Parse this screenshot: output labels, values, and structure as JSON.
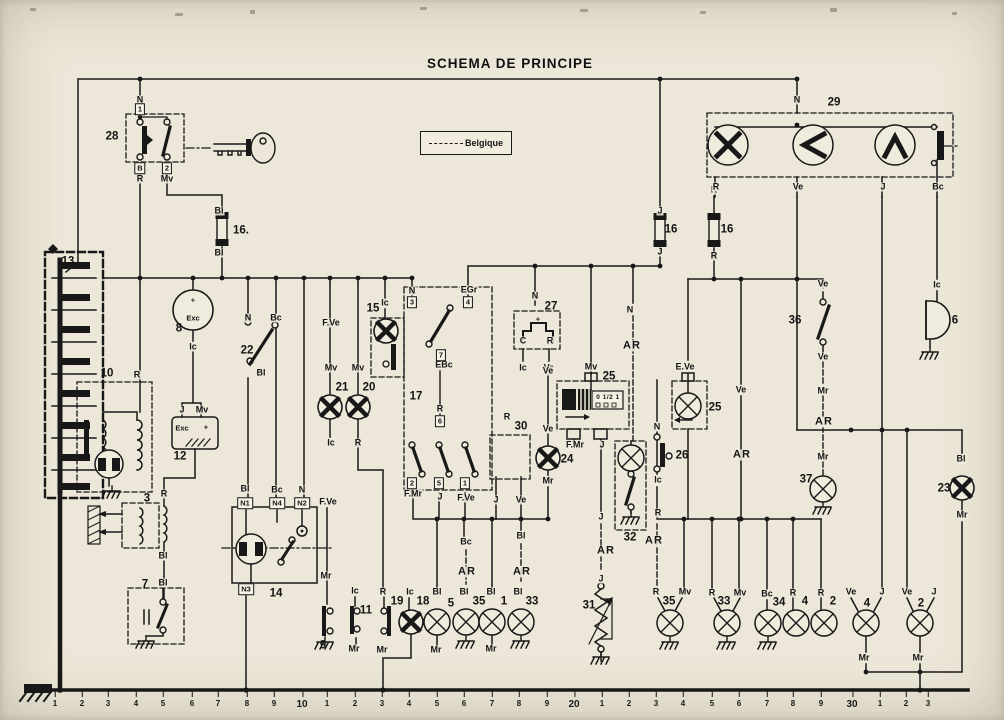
{
  "title": "SCHEMA DE PRINCIPE",
  "legend": {
    "label": "Belgique"
  },
  "colors": {
    "paper": "#ece7d8",
    "ink": "#181818"
  },
  "labels": [
    {
      "t": "28",
      "x": 112,
      "y": 137,
      "k": "c"
    },
    {
      "t": "16.",
      "x": 241,
      "y": 231,
      "k": "c"
    },
    {
      "t": "13",
      "x": 68,
      "y": 262,
      "k": "c"
    },
    {
      "t": "8",
      "x": 179,
      "y": 329,
      "k": "c"
    },
    {
      "t": "22",
      "x": 247,
      "y": 351,
      "k": "c"
    },
    {
      "t": "10",
      "x": 107,
      "y": 374,
      "k": "c"
    },
    {
      "t": "15",
      "x": 373,
      "y": 309,
      "k": "c"
    },
    {
      "t": "21",
      "x": 342,
      "y": 388,
      "k": "c"
    },
    {
      "t": "20",
      "x": 369,
      "y": 388,
      "k": "c"
    },
    {
      "t": "17",
      "x": 416,
      "y": 397,
      "k": "c"
    },
    {
      "t": "27",
      "x": 551,
      "y": 307,
      "k": "c"
    },
    {
      "t": "12",
      "x": 180,
      "y": 457,
      "k": "c"
    },
    {
      "t": "3",
      "x": 147,
      "y": 499,
      "k": "c"
    },
    {
      "t": "30",
      "x": 521,
      "y": 427,
      "k": "c"
    },
    {
      "t": "24",
      "x": 567,
      "y": 460,
      "k": "c"
    },
    {
      "t": "25",
      "x": 609,
      "y": 377,
      "k": "c"
    },
    {
      "t": "25",
      "x": 715,
      "y": 408,
      "k": "c"
    },
    {
      "t": "26",
      "x": 682,
      "y": 456,
      "k": "c"
    },
    {
      "t": "32",
      "x": 630,
      "y": 538,
      "k": "c"
    },
    {
      "t": "14",
      "x": 276,
      "y": 594,
      "k": "c"
    },
    {
      "t": "7",
      "x": 145,
      "y": 585,
      "k": "c"
    },
    {
      "t": "9",
      "x": 323,
      "y": 646,
      "k": "c"
    },
    {
      "t": "11",
      "x": 366,
      "y": 611,
      "k": "c"
    },
    {
      "t": "19",
      "x": 397,
      "y": 602,
      "k": "c"
    },
    {
      "t": "18",
      "x": 423,
      "y": 602,
      "k": "c"
    },
    {
      "t": "5",
      "x": 451,
      "y": 604,
      "k": "c"
    },
    {
      "t": "35",
      "x": 479,
      "y": 602,
      "k": "c"
    },
    {
      "t": "1",
      "x": 504,
      "y": 602,
      "k": "c"
    },
    {
      "t": "33",
      "x": 532,
      "y": 602,
      "k": "c"
    },
    {
      "t": "31",
      "x": 589,
      "y": 606,
      "k": "c"
    },
    {
      "t": "35",
      "x": 669,
      "y": 602,
      "k": "c"
    },
    {
      "t": "33",
      "x": 724,
      "y": 602,
      "k": "c"
    },
    {
      "t": "34",
      "x": 779,
      "y": 603,
      "k": "c"
    },
    {
      "t": "4",
      "x": 805,
      "y": 602,
      "k": "c"
    },
    {
      "t": "2",
      "x": 833,
      "y": 602,
      "k": "c"
    },
    {
      "t": "4",
      "x": 867,
      "y": 604,
      "k": "c"
    },
    {
      "t": "2",
      "x": 921,
      "y": 604,
      "k": "c"
    },
    {
      "t": "36",
      "x": 795,
      "y": 321,
      "k": "c"
    },
    {
      "t": "37",
      "x": 806,
      "y": 480,
      "k": "c"
    },
    {
      "t": "6",
      "x": 955,
      "y": 321,
      "k": "c"
    },
    {
      "t": "23",
      "x": 944,
      "y": 489,
      "k": "c"
    },
    {
      "t": "29",
      "x": 834,
      "y": 103,
      "k": "c"
    },
    {
      "t": "16",
      "x": 671,
      "y": 230,
      "k": "c"
    },
    {
      "t": "16",
      "x": 727,
      "y": 230,
      "k": "c"
    },
    {
      "t": "N",
      "x": 140,
      "y": 100,
      "k": "w"
    },
    {
      "t": "R",
      "x": 140,
      "y": 179,
      "k": "w"
    },
    {
      "t": "Mv",
      "x": 167,
      "y": 179,
      "k": "w"
    },
    {
      "t": "Bl",
      "x": 219,
      "y": 211,
      "k": "w"
    },
    {
      "t": "Bl",
      "x": 219,
      "y": 253,
      "k": "w"
    },
    {
      "t": "Ic",
      "x": 193,
      "y": 347,
      "k": "w"
    },
    {
      "t": "N",
      "x": 248,
      "y": 318,
      "k": "w"
    },
    {
      "t": "Bc",
      "x": 276,
      "y": 318,
      "k": "w"
    },
    {
      "t": "Bl",
      "x": 261,
      "y": 373,
      "k": "w"
    },
    {
      "t": "F.Ve",
      "x": 331,
      "y": 323,
      "k": "w"
    },
    {
      "t": "Mv",
      "x": 331,
      "y": 368,
      "k": "w"
    },
    {
      "t": "Ic",
      "x": 331,
      "y": 443,
      "k": "w"
    },
    {
      "t": "Mv",
      "x": 358,
      "y": 368,
      "k": "w"
    },
    {
      "t": "R",
      "x": 358,
      "y": 443,
      "k": "w"
    },
    {
      "t": "Ic",
      "x": 385,
      "y": 303,
      "k": "w"
    },
    {
      "t": "N",
      "x": 412,
      "y": 291,
      "k": "w"
    },
    {
      "t": "EGr",
      "x": 469,
      "y": 290,
      "k": "w"
    },
    {
      "t": "EBc",
      "x": 444,
      "y": 365,
      "k": "w"
    },
    {
      "t": "R",
      "x": 440,
      "y": 409,
      "k": "w"
    },
    {
      "t": "F.Mr",
      "x": 413,
      "y": 494,
      "k": "w"
    },
    {
      "t": "J",
      "x": 440,
      "y": 497,
      "k": "w"
    },
    {
      "t": "F.Ve",
      "x": 466,
      "y": 498,
      "k": "w"
    },
    {
      "t": "N",
      "x": 535,
      "y": 296,
      "k": "w"
    },
    {
      "t": "C",
      "x": 523,
      "y": 341,
      "k": "w"
    },
    {
      "t": "R",
      "x": 550,
      "y": 341,
      "k": "w"
    },
    {
      "t": "Ic",
      "x": 523,
      "y": 368,
      "k": "w"
    },
    {
      "t": "Ve",
      "x": 549,
      "y": 368,
      "k": "w"
    },
    {
      "t": "R",
      "x": 507,
      "y": 417,
      "k": "w"
    },
    {
      "t": "J",
      "x": 496,
      "y": 500,
      "k": "w"
    },
    {
      "t": "Ve",
      "x": 521,
      "y": 500,
      "k": "w"
    },
    {
      "t": "Ve",
      "x": 548,
      "y": 371,
      "k": "w"
    },
    {
      "t": "Ve",
      "x": 548,
      "y": 429,
      "k": "w"
    },
    {
      "t": "Mr",
      "x": 548,
      "y": 481,
      "k": "w"
    },
    {
      "t": "Mv",
      "x": 591,
      "y": 367,
      "k": "w"
    },
    {
      "t": "F.Mr",
      "x": 575,
      "y": 445,
      "k": "w"
    },
    {
      "t": "J",
      "x": 602,
      "y": 445,
      "k": "w"
    },
    {
      "t": "N",
      "x": 630,
      "y": 310,
      "k": "w"
    },
    {
      "t": "J",
      "x": 660,
      "y": 211,
      "k": "w"
    },
    {
      "t": "J",
      "x": 660,
      "y": 252,
      "k": "w"
    },
    {
      "t": "R",
      "x": 714,
      "y": 190,
      "k": "w"
    },
    {
      "t": "R",
      "x": 714,
      "y": 256,
      "k": "w"
    },
    {
      "t": "N",
      "x": 797,
      "y": 100,
      "k": "w"
    },
    {
      "t": "R",
      "x": 716,
      "y": 187,
      "k": "w"
    },
    {
      "t": "Ve",
      "x": 798,
      "y": 187,
      "k": "w"
    },
    {
      "t": "J",
      "x": 883,
      "y": 187,
      "k": "w"
    },
    {
      "t": "Bc",
      "x": 938,
      "y": 187,
      "k": "w"
    },
    {
      "t": "Ic",
      "x": 937,
      "y": 285,
      "k": "w"
    },
    {
      "t": "Ve",
      "x": 823,
      "y": 284,
      "k": "w"
    },
    {
      "t": "Ve",
      "x": 823,
      "y": 357,
      "k": "w"
    },
    {
      "t": "Mr",
      "x": 823,
      "y": 391,
      "k": "w"
    },
    {
      "t": "Mr",
      "x": 823,
      "y": 457,
      "k": "w"
    },
    {
      "t": "Ve",
      "x": 741,
      "y": 390,
      "k": "w"
    },
    {
      "t": "E.Ve",
      "x": 685,
      "y": 367,
      "k": "w"
    },
    {
      "t": "N",
      "x": 657,
      "y": 427,
      "k": "w"
    },
    {
      "t": "Ic",
      "x": 658,
      "y": 480,
      "k": "w"
    },
    {
      "t": "R",
      "x": 658,
      "y": 513,
      "k": "w"
    },
    {
      "t": "Bl",
      "x": 961,
      "y": 459,
      "k": "w"
    },
    {
      "t": "Mr",
      "x": 962,
      "y": 515,
      "k": "w"
    },
    {
      "t": "Bc",
      "x": 466,
      "y": 542,
      "k": "w"
    },
    {
      "t": "Bl",
      "x": 521,
      "y": 536,
      "k": "w"
    },
    {
      "t": "J",
      "x": 601,
      "y": 517,
      "k": "w"
    },
    {
      "t": "J",
      "x": 601,
      "y": 579,
      "k": "w"
    },
    {
      "t": "F.Ve",
      "x": 328,
      "y": 502,
      "k": "w"
    },
    {
      "t": "Mr",
      "x": 326,
      "y": 576,
      "k": "w"
    },
    {
      "t": "Ic",
      "x": 355,
      "y": 591,
      "k": "w"
    },
    {
      "t": "Mr",
      "x": 354,
      "y": 649,
      "k": "w"
    },
    {
      "t": "R",
      "x": 383,
      "y": 592,
      "k": "w"
    },
    {
      "t": "Mr",
      "x": 382,
      "y": 650,
      "k": "w"
    },
    {
      "t": "Ic",
      "x": 410,
      "y": 592,
      "k": "w"
    },
    {
      "t": "Bl",
      "x": 437,
      "y": 592,
      "k": "w"
    },
    {
      "t": "Mr",
      "x": 436,
      "y": 650,
      "k": "w"
    },
    {
      "t": "Bl",
      "x": 464,
      "y": 592,
      "k": "w"
    },
    {
      "t": "Bl",
      "x": 491,
      "y": 592,
      "k": "w"
    },
    {
      "t": "Mr",
      "x": 491,
      "y": 649,
      "k": "w"
    },
    {
      "t": "Bl",
      "x": 518,
      "y": 592,
      "k": "w"
    },
    {
      "t": "Bl",
      "x": 245,
      "y": 489,
      "k": "w"
    },
    {
      "t": "Bc",
      "x": 277,
      "y": 490,
      "k": "w"
    },
    {
      "t": "N",
      "x": 302,
      "y": 490,
      "k": "w"
    },
    {
      "t": "R",
      "x": 164,
      "y": 494,
      "k": "w"
    },
    {
      "t": "Bl",
      "x": 163,
      "y": 556,
      "k": "w"
    },
    {
      "t": "Bl",
      "x": 163,
      "y": 583,
      "k": "w"
    },
    {
      "t": "R",
      "x": 137,
      "y": 375,
      "k": "w"
    },
    {
      "t": "J",
      "x": 182,
      "y": 410,
      "k": "w"
    },
    {
      "t": "Mv",
      "x": 202,
      "y": 410,
      "k": "w"
    },
    {
      "t": "R",
      "x": 656,
      "y": 592,
      "k": "w"
    },
    {
      "t": "Mv",
      "x": 685,
      "y": 592,
      "k": "w"
    },
    {
      "t": "R",
      "x": 712,
      "y": 593,
      "k": "w"
    },
    {
      "t": "Mv",
      "x": 740,
      "y": 593,
      "k": "w"
    },
    {
      "t": "Bc",
      "x": 767,
      "y": 594,
      "k": "w"
    },
    {
      "t": "R",
      "x": 793,
      "y": 593,
      "k": "w"
    },
    {
      "t": "R",
      "x": 821,
      "y": 593,
      "k": "w"
    },
    {
      "t": "Ve",
      "x": 851,
      "y": 592,
      "k": "w"
    },
    {
      "t": "J",
      "x": 882,
      "y": 592,
      "k": "w"
    },
    {
      "t": "Ve",
      "x": 907,
      "y": 592,
      "k": "w"
    },
    {
      "t": "J",
      "x": 934,
      "y": 592,
      "k": "w"
    },
    {
      "t": "Mr",
      "x": 864,
      "y": 658,
      "k": "w"
    },
    {
      "t": "Mr",
      "x": 918,
      "y": 658,
      "k": "w"
    },
    {
      "t": "AR",
      "x": 632,
      "y": 346,
      "k": "ar"
    },
    {
      "t": "AR",
      "x": 824,
      "y": 422,
      "k": "ar"
    },
    {
      "t": "AR",
      "x": 742,
      "y": 455,
      "k": "ar"
    },
    {
      "t": "AR",
      "x": 654,
      "y": 541,
      "k": "ar"
    },
    {
      "t": "AR",
      "x": 467,
      "y": 572,
      "k": "ar"
    },
    {
      "t": "AR",
      "x": 522,
      "y": 572,
      "k": "ar"
    },
    {
      "t": "AR",
      "x": 606,
      "y": 551,
      "k": "ar"
    },
    {
      "t": "Exc",
      "x": 193,
      "y": 318,
      "k": "in"
    },
    {
      "t": "+",
      "x": 193,
      "y": 300,
      "k": "in"
    },
    {
      "t": "Exc",
      "x": 182,
      "y": 428,
      "k": "in"
    },
    {
      "t": "+",
      "x": 206,
      "y": 427,
      "k": "in"
    },
    {
      "t": "+",
      "x": 538,
      "y": 319,
      "k": "in"
    },
    {
      "t": "0 1/2 1",
      "x": 608,
      "y": 398,
      "k": "tiny"
    },
    {
      "t": "1",
      "x": 140,
      "y": 109,
      "k": "t"
    },
    {
      "t": "B",
      "x": 140,
      "y": 168,
      "k": "t"
    },
    {
      "t": "2",
      "x": 167,
      "y": 168,
      "k": "t"
    },
    {
      "t": "3",
      "x": 412,
      "y": 302,
      "k": "t"
    },
    {
      "t": "4",
      "x": 468,
      "y": 302,
      "k": "t"
    },
    {
      "t": "7",
      "x": 441,
      "y": 355,
      "k": "t"
    },
    {
      "t": "6",
      "x": 440,
      "y": 421,
      "k": "t"
    },
    {
      "t": "2",
      "x": 412,
      "y": 483,
      "k": "t"
    },
    {
      "t": "5",
      "x": 439,
      "y": 483,
      "k": "t"
    },
    {
      "t": "1",
      "x": 465,
      "y": 483,
      "k": "t"
    },
    {
      "t": "N1",
      "x": 245,
      "y": 503,
      "k": "t"
    },
    {
      "t": "N4",
      "x": 277,
      "y": 503,
      "k": "t"
    },
    {
      "t": "N2",
      "x": 302,
      "y": 503,
      "k": "t"
    },
    {
      "t": "N3",
      "x": 246,
      "y": 589,
      "k": "t"
    }
  ],
  "ruler": {
    "ticks": [
      {
        "t": "1",
        "x": 55
      },
      {
        "t": "2",
        "x": 82
      },
      {
        "t": "3",
        "x": 108
      },
      {
        "t": "4",
        "x": 136
      },
      {
        "t": "5",
        "x": 163
      },
      {
        "t": "6",
        "x": 192
      },
      {
        "t": "7",
        "x": 218
      },
      {
        "t": "8",
        "x": 247
      },
      {
        "t": "9",
        "x": 274
      },
      {
        "t": "10",
        "x": 302
      },
      {
        "t": "1",
        "x": 327
      },
      {
        "t": "2",
        "x": 355
      },
      {
        "t": "3",
        "x": 382
      },
      {
        "t": "4",
        "x": 409
      },
      {
        "t": "5",
        "x": 437
      },
      {
        "t": "6",
        "x": 464
      },
      {
        "t": "7",
        "x": 492
      },
      {
        "t": "8",
        "x": 519
      },
      {
        "t": "9",
        "x": 547
      },
      {
        "t": "20",
        "x": 574
      },
      {
        "t": "1",
        "x": 602
      },
      {
        "t": "2",
        "x": 629
      },
      {
        "t": "3",
        "x": 656
      },
      {
        "t": "4",
        "x": 683
      },
      {
        "t": "5",
        "x": 712
      },
      {
        "t": "6",
        "x": 739
      },
      {
        "t": "7",
        "x": 767
      },
      {
        "t": "8",
        "x": 793
      },
      {
        "t": "9",
        "x": 821
      },
      {
        "t": "30",
        "x": 852
      },
      {
        "t": "1",
        "x": 880
      },
      {
        "t": "2",
        "x": 906
      },
      {
        "t": "3",
        "x": 928
      }
    ]
  }
}
